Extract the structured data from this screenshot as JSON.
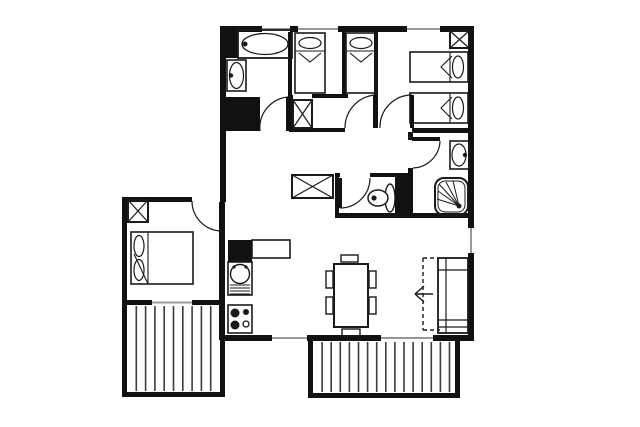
{
  "meta": {
    "title": "apartment-floor-plan",
    "canvas": {
      "w": 640,
      "h": 427,
      "background": "#ffffff"
    },
    "colors": {
      "wall": "#111111",
      "line": "#1a1a1a",
      "window": "#9a9a9a",
      "stripe": "#3c3c3c",
      "floor": "#ffffff"
    }
  },
  "walls": [
    [
      222,
      26,
      252,
      6
    ],
    [
      468,
      26,
      6,
      202
    ],
    [
      468,
      253,
      6,
      87
    ],
    [
      220,
      26,
      6,
      176
    ],
    [
      122,
      197,
      70,
      5
    ],
    [
      122,
      202,
      5,
      195
    ],
    [
      122,
      300,
      30,
      5
    ],
    [
      192,
      300,
      33,
      5
    ],
    [
      122,
      392,
      103,
      5
    ],
    [
      220,
      305,
      5,
      92
    ],
    [
      219,
      202,
      6,
      138
    ],
    [
      222,
      335,
      50,
      6
    ],
    [
      307,
      335,
      74,
      6
    ],
    [
      433,
      335,
      41,
      6
    ],
    [
      308,
      341,
      5,
      57
    ],
    [
      308,
      393,
      152,
      5
    ],
    [
      455,
      341,
      5,
      57
    ],
    [
      288,
      26,
      4,
      71
    ],
    [
      342,
      26,
      4,
      69
    ],
    [
      312,
      94,
      36,
      4
    ],
    [
      374,
      26,
      4,
      102
    ],
    [
      290,
      128,
      55,
      4
    ],
    [
      289,
      95,
      4,
      37
    ],
    [
      412,
      128,
      56,
      5
    ],
    [
      408,
      132,
      5,
      8
    ],
    [
      408,
      168,
      5,
      50
    ],
    [
      335,
      173,
      4,
      45
    ],
    [
      335,
      173,
      5,
      4
    ],
    [
      370,
      173,
      42,
      4
    ],
    [
      335,
      213,
      139,
      5
    ]
  ],
  "fills": [
    [
      222,
      28,
      16,
      30
    ],
    [
      224,
      97,
      36,
      34
    ],
    [
      395,
      175,
      18,
      42
    ],
    [
      228,
      240,
      24,
      22
    ]
  ],
  "windows": [
    {
      "box": [
        262,
        26,
        28,
        6
      ],
      "dir": "h"
    },
    {
      "box": [
        298,
        26,
        40,
        6
      ],
      "dir": "h"
    },
    {
      "box": [
        407,
        26,
        33,
        6
      ],
      "dir": "h"
    },
    {
      "box": [
        468,
        228,
        6,
        25
      ],
      "dir": "v"
    },
    {
      "box": [
        152,
        300,
        40,
        5
      ],
      "dir": "h"
    },
    {
      "box": [
        272,
        335,
        35,
        6
      ],
      "dir": "h"
    },
    {
      "box": [
        381,
        335,
        52,
        6
      ],
      "dir": "h"
    }
  ],
  "doors": [
    {
      "name": "bathroom-door",
      "leaf": [
        286,
        97,
        4,
        34
      ],
      "arc": "M 260,131 A 31,31 0 0 1 288,97"
    },
    {
      "name": "alcove-door",
      "leaf": [
        373,
        95,
        4,
        33
      ],
      "arc": "M 345,128 A 33,33 0 0 1 375,95"
    },
    {
      "name": "bedroom-right-door",
      "leaf": [
        410,
        95,
        4,
        33
      ],
      "arc": "M 380,128 A 32,32 0 0 1 412,95"
    },
    {
      "name": "shower-room-door",
      "leaf": [
        412,
        137,
        28,
        4
      ],
      "arc": "M 440,141 A 28,28 0 0 1 413,168"
    },
    {
      "name": "wc-door",
      "leaf": [
        338,
        178,
        4,
        30
      ],
      "arc": "M 340,208 A 30,30 0 0 0 370,178"
    },
    {
      "name": "bedroom-left-door",
      "leaf": null,
      "arc": "M 192,201 A 30,30 0 0 0 222,231"
    }
  ],
  "balconies": [
    {
      "name": "balcony-left",
      "inner": [
        127,
        305,
        93,
        87
      ],
      "stripe_step": 9.3
    },
    {
      "name": "balcony-bottom",
      "inner": [
        313,
        341,
        142,
        52
      ],
      "stripe_step": 9.1
    }
  ],
  "wardrobes": [
    [
      450,
      31,
      19,
      17
    ],
    [
      293,
      100,
      19,
      28
    ],
    [
      292,
      175,
      41,
      23
    ],
    [
      128,
      200,
      20,
      22
    ]
  ],
  "furniture": {
    "bathtub": {
      "rect": [
        238,
        30,
        54,
        28
      ],
      "oval": [
        265,
        44,
        23,
        10.5
      ],
      "tap": [
        245,
        44
      ]
    },
    "sinks": [
      {
        "name": "bathroom-sink",
        "rect": [
          227,
          60,
          19,
          31
        ],
        "oval": [
          236.5,
          75.5,
          7,
          13
        ],
        "tap": [
          231,
          75.5
        ]
      },
      {
        "name": "shower-room-sink",
        "rect": [
          450,
          141,
          19,
          28
        ],
        "oval": [
          459,
          155,
          7,
          11
        ],
        "tap": [
          465,
          155
        ]
      }
    ],
    "shower": {
      "outer": [
        435,
        178,
        33,
        37,
        9
      ],
      "inner": [
        438,
        181,
        27,
        31,
        7
      ],
      "dot": [
        459,
        206
      ],
      "rays": [
        [
          439,
          184
        ],
        [
          446,
          182
        ],
        [
          453,
          181
        ],
        [
          438,
          191
        ],
        [
          437,
          199
        ]
      ]
    },
    "toilet": {
      "bowl": [
        378,
        198,
        10,
        8
      ],
      "dot": [
        374,
        198
      ],
      "tank": [
        390,
        198,
        5,
        14
      ]
    },
    "beds_vertical": [
      [
        295,
        33,
        30,
        60
      ],
      [
        346,
        33,
        30,
        60
      ]
    ],
    "beds_horizontal": [
      [
        410,
        52,
        58,
        30
      ],
      [
        410,
        93,
        58,
        30
      ]
    ],
    "double_bed": {
      "rect": [
        131,
        232,
        62,
        52
      ],
      "divider_x": 148,
      "pillows": [
        [
          139,
          246,
          5,
          10.5
        ],
        [
          139,
          270,
          5,
          10.5
        ]
      ],
      "flap": [
        [
          148,
          284
        ],
        [
          134,
          254
        ]
      ]
    },
    "kitchen": {
      "counter": [
        252,
        240,
        38,
        18
      ],
      "sink_unit": {
        "rect": [
          228,
          262,
          24,
          33
        ],
        "bowl": [
          240,
          274,
          9.5
        ],
        "dots": [
          [
            234,
            267
          ],
          [
            246,
            267
          ]
        ],
        "drainer_y": [
          285,
          288,
          291,
          294
        ],
        "drainer_x": [
          230,
          250
        ]
      },
      "stove": {
        "rect": [
          228,
          305,
          24,
          28
        ],
        "burners_filled": [
          [
            235,
            313,
            4.5
          ],
          [
            246,
            312,
            3
          ],
          [
            235,
            325,
            4.5
          ]
        ],
        "burners_outline": [
          [
            246,
            324,
            3
          ]
        ]
      }
    },
    "dining": {
      "table": [
        334,
        264,
        34,
        63
      ],
      "chairs": [
        [
          326,
          271,
          7,
          17
        ],
        [
          326,
          297,
          7,
          17
        ],
        [
          369,
          271,
          7,
          17
        ],
        [
          369,
          297,
          7,
          17
        ],
        [
          341,
          255,
          17,
          7
        ],
        [
          342,
          329,
          18,
          7
        ]
      ]
    },
    "sofa": {
      "rect": [
        438,
        258,
        30,
        75
      ],
      "vline_x": 446,
      "hlines_y": [
        270,
        320,
        327
      ],
      "dashed": [
        [
          [
            423,
            258
          ],
          [
            423,
            330
          ]
        ],
        [
          [
            423,
            330
          ],
          [
            440,
            330
          ]
        ],
        [
          [
            423,
            258
          ],
          [
            438,
            258
          ]
        ]
      ],
      "arrow": {
        "shaft": [
          [
            415,
            294
          ],
          [
            433,
            294
          ]
        ],
        "head": [
          [
            424,
            286
          ],
          [
            424,
            302
          ]
        ]
      }
    }
  }
}
